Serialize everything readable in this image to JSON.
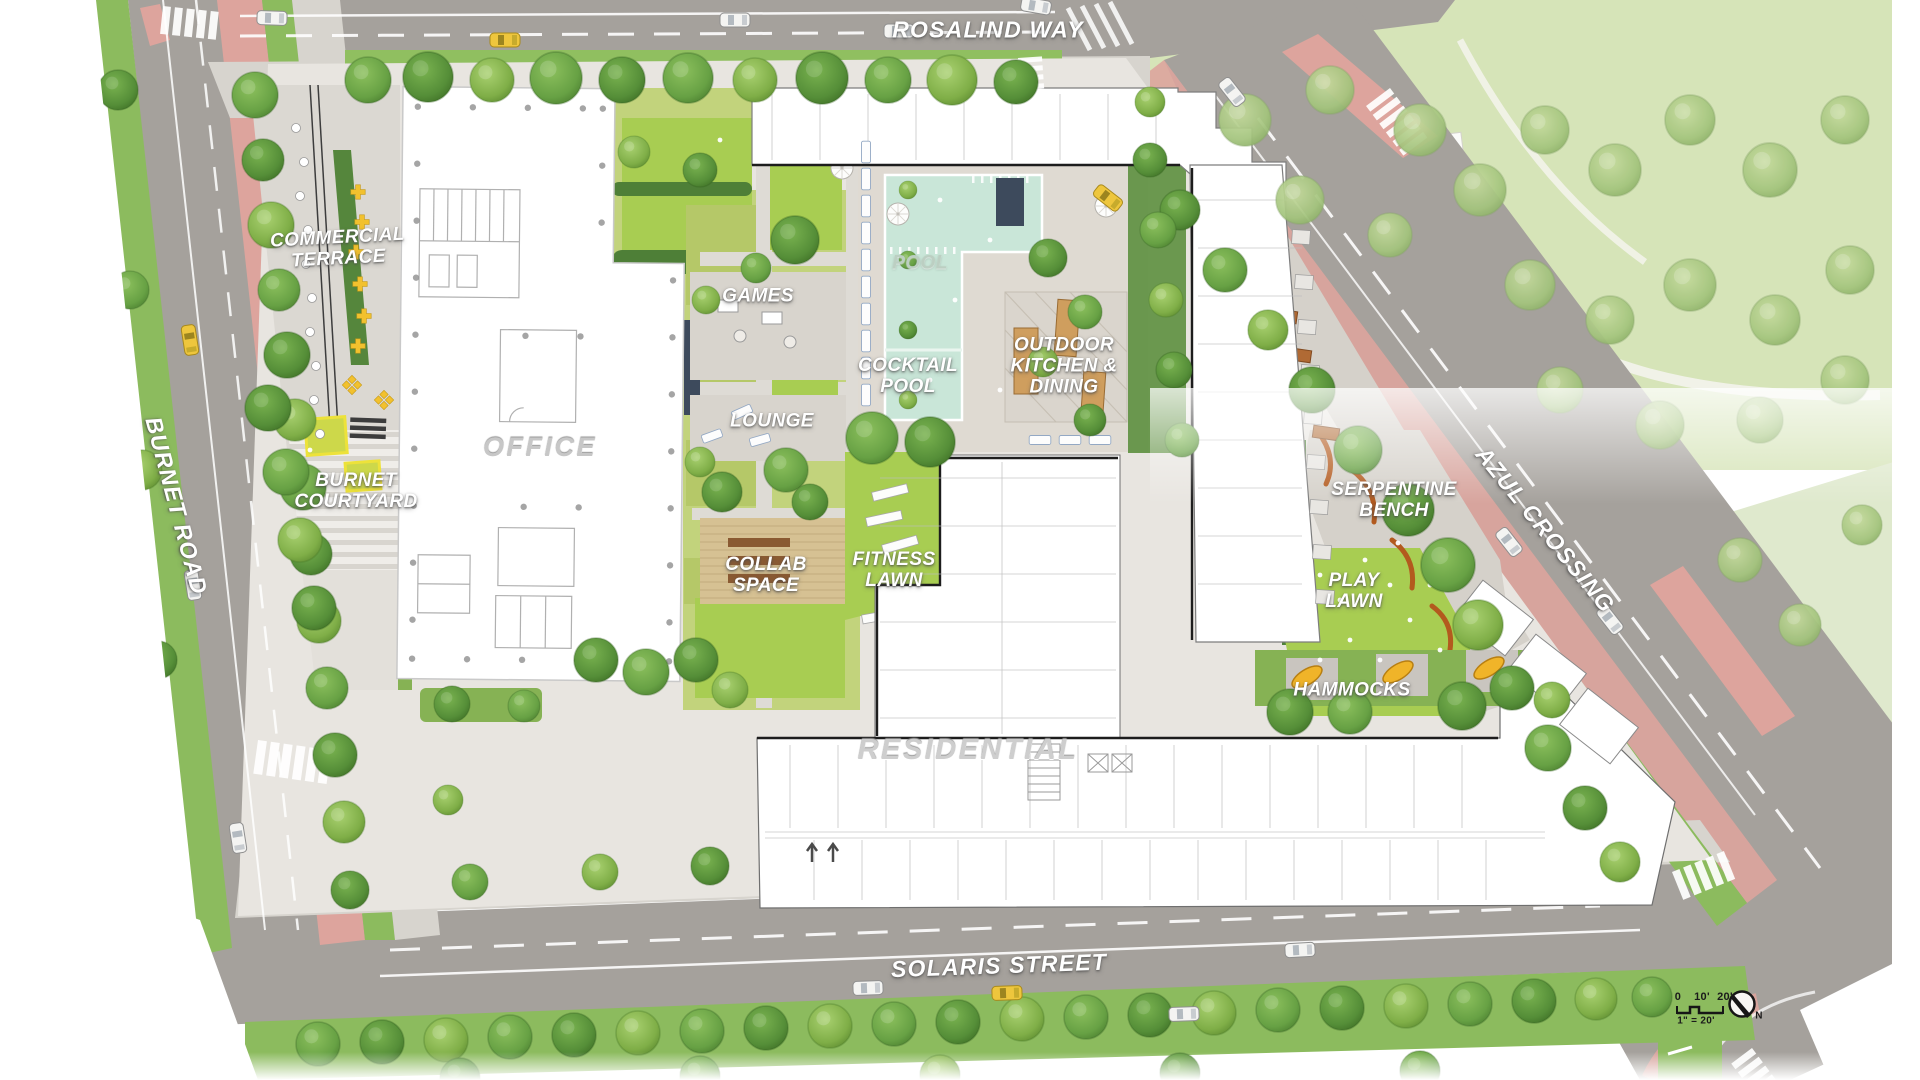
{
  "title": "Landscape site plan",
  "streets": {
    "rosalind_way": {
      "label": "ROSALIND WAY"
    },
    "burnet_road": {
      "label": "BURNET ROAD"
    },
    "solaris_street": {
      "label": "SOLARIS STREET"
    },
    "azul_crossing": {
      "label": "AZUL CROSSING"
    }
  },
  "buildings": {
    "office": {
      "label": "OFFICE"
    },
    "residential": {
      "label": "RESIDENTIAL"
    }
  },
  "amenities": {
    "commercial_terrace": {
      "label": "COMMERCIAL\nTERRACE"
    },
    "burnet_courtyard": {
      "label": "BURNET\nCOURTYARD"
    },
    "games": {
      "label": "GAMES"
    },
    "lounge": {
      "label": "LOUNGE"
    },
    "collab_space": {
      "label": "COLLAB\nSPACE"
    },
    "pool": {
      "label": "POOL"
    },
    "cocktail_pool": {
      "label": "COCKTAIL\nPOOL"
    },
    "outdoor_kitchen_dining": {
      "label": "OUTDOOR\nKITCHEN &\nDINING"
    },
    "fitness_lawn": {
      "label": "FITNESS\nLAWN"
    },
    "serpentine_bench": {
      "label": "SERPENTINE\nBENCH"
    },
    "play_lawn": {
      "label": "PLAY\nLAWN"
    },
    "hammocks": {
      "label": "HAMMOCKS"
    }
  },
  "legend": {
    "scale_zero": "0",
    "scale_ten": "10'",
    "scale_twenty": "20'",
    "scale_note": "1\" = 20'",
    "north": "N"
  },
  "colors": {
    "road": "#a5a19c",
    "sidewalk": "#d7d4ce",
    "site_paving": "#e8e5e0",
    "bike_lane": "#dda49d",
    "grass": "#8cbb5e",
    "lawn": "#a8cd52",
    "hedge": "#55863c",
    "pool_water": "#c9e6d8",
    "building": "#ffffff",
    "wood_deck": "#d6c193",
    "bench_orange": "#b35a1e",
    "furniture_yellow": "#f0b429",
    "taxi_yellow": "#eec63d",
    "navy_wall": "#3d4a5c"
  }
}
